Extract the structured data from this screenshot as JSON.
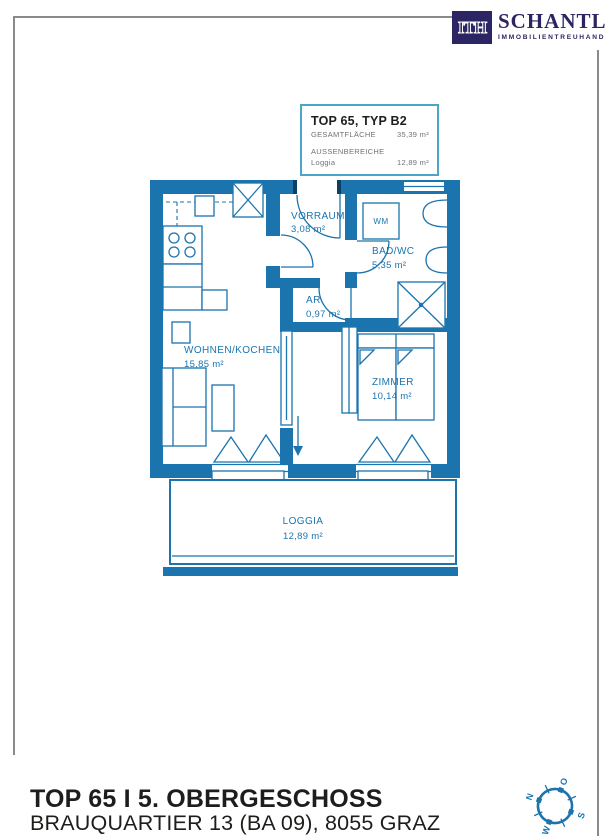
{
  "brand": {
    "mark": "ITH",
    "name": "SCHANTL",
    "tagline": "IMMOBILIENTREUHAND"
  },
  "info_box": {
    "title": "TOP 65, TYP B2",
    "total_label": "GESAMTFLÄCHE",
    "total_value": "35,39 m²",
    "outdoor_label": "AUSSENBEREICHE",
    "outdoor_item": "Loggia",
    "outdoor_value": "12,89 m²"
  },
  "plan": {
    "rooms": {
      "vorraum": {
        "name": "VORRAUM",
        "area": "3,08 m²"
      },
      "bad": {
        "name": "BAD/WC",
        "area": "5,35 m²"
      },
      "ar": {
        "name": "AR",
        "area": "0,97 m²"
      },
      "wohnen": {
        "name": "WOHNEN/KOCHEN",
        "area": "15,85 m²"
      },
      "zimmer": {
        "name": "ZIMMER",
        "area": "10,14 m²"
      },
      "loggia": {
        "name": "LOGGIA",
        "area": "12,89 m²"
      }
    },
    "fixtures": {
      "wm": "WM"
    }
  },
  "compass": {
    "north": "N",
    "east": "O",
    "south": "S",
    "west": "W"
  },
  "footer": {
    "title": "TOP 65 I 5. OBERGESCHOSS",
    "address": "BRAUQUARTIER 13 (BA 09), 8055 GRAZ"
  },
  "colors": {
    "wall_blue": "#1b74ae",
    "info_border": "#4aa5c6",
    "logo_navy": "#2b2663",
    "text_dark": "#1d1d1b",
    "frame_grey": "#8a8a8a"
  }
}
